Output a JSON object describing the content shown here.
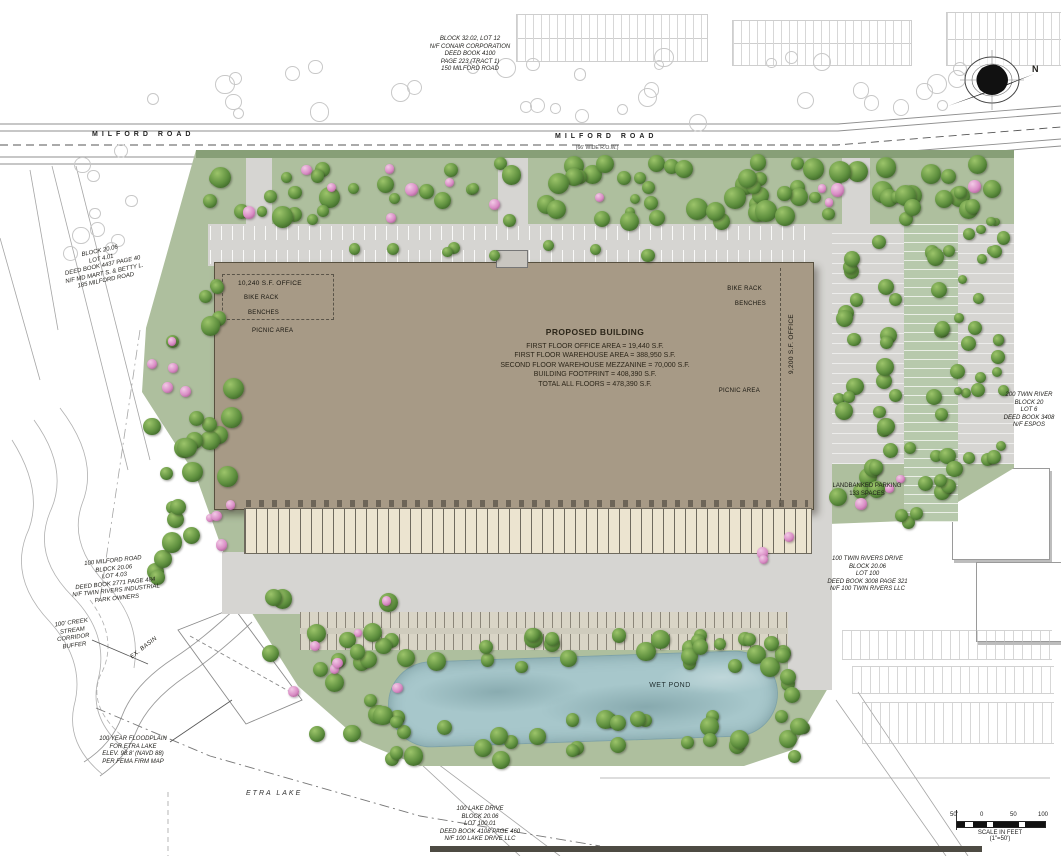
{
  "roads": {
    "milford_left": "MILFORD ROAD",
    "milford_center": "MILFORD ROAD",
    "milford_row": "(66' WIDE R.O.W.)"
  },
  "compass": {
    "north": "N"
  },
  "parcels": {
    "north": [
      "BLOCK 32.02, LOT 12",
      "N/F CONAIR CORPORATION",
      "DEED BOOK 4100",
      "PAGE 223 (TRACT 1)",
      "150 MILFORD ROAD"
    ],
    "west": [
      "BLOCK 20.06",
      "LOT 4.01",
      "DEED BOOK 4437 PAGE 40",
      "N/F MD MART S. & BETTY L.",
      "185 MILFORD ROAD"
    ],
    "southwest": [
      "100 MILFORD ROAD",
      "BLOCK 20.06",
      "LOT 4.03",
      "DEED BOOK 2771 PAGE 484",
      "N/F TWIN RIVERS INDUSTRIAL",
      "PARK OWNERS"
    ],
    "south": [
      "100 LAKE DRIVE",
      "BLOCK 20.06",
      "LOT 100.01",
      "DEED BOOK 4108 PAGE 460",
      "N/F 100 LAKE DRIVE LLC"
    ],
    "east": [
      "100 TWIN RIVERS DRIVE",
      "BLOCK 20.06",
      "LOT 100",
      "DEED BOOK 3008 PAGE 321",
      "N/F 100 TWIN RIVERS LLC"
    ],
    "northeast": [
      "200 TWIN RIVER",
      "BLOCK 20",
      "LOT 6",
      "DEED BOOK 3408",
      "N/F ESPOS"
    ]
  },
  "building": {
    "title": "PROPOSED BUILDING",
    "stats": [
      "FIRST FLOOR OFFICE AREA = 19,440 S.F.",
      "FIRST FLOOR WAREHOUSE AREA = 388,950 S.F.",
      "SECOND FLOOR WAREHOUSE MEZZANINE = 70,000 S.F.",
      "BUILDING FOOTPRINT = 408,390 S.F.",
      "TOTAL ALL FLOORS = 478,390 S.F."
    ],
    "office_west": "10,240 S.F. OFFICE",
    "office_east": "9,200 S.F. OFFICE"
  },
  "amenities": {
    "bike_rack_west": "BIKE RACK",
    "benches_west": "BENCHES",
    "picnic_west": "PICNIC AREA",
    "bike_rack_east": "BIKE RACK",
    "benches_east": "BENCHES",
    "picnic_east": "PICNIC AREA"
  },
  "features": {
    "wet_pond": "WET POND",
    "landbanked": [
      "LANDBANKED PARKING",
      "133 SPACES"
    ],
    "etra_lake": "ETRA LAKE",
    "ex_basin": "EX. BASIN"
  },
  "notes": {
    "creek_buffer": [
      "100' CREEK",
      "STREAM",
      "CORRIDOR",
      "BUFFER"
    ],
    "floodplain": [
      "100 YEAR FLOODPLAIN",
      "FOR ETRA LAKE",
      "ELEV. 98.8' (NAVD 88)",
      "PER FEMA FIRM MAP"
    ]
  },
  "scale_bar": {
    "ticks": [
      "50'",
      "0",
      "50",
      "100"
    ],
    "caption_line1": "SCALE IN FEET",
    "caption_line2": "(1\"=50')"
  },
  "colors": {
    "building_fill": "#a79a86",
    "site_green": "#aebf9e",
    "landbank_green": "#b7c9ac",
    "pavement": "#d6d5d2",
    "pond_blue": "#a7c7cb",
    "tree_green": "#4a7a33",
    "flower_pink": "#d98cc5",
    "dock_cream": "#ece4d0"
  }
}
